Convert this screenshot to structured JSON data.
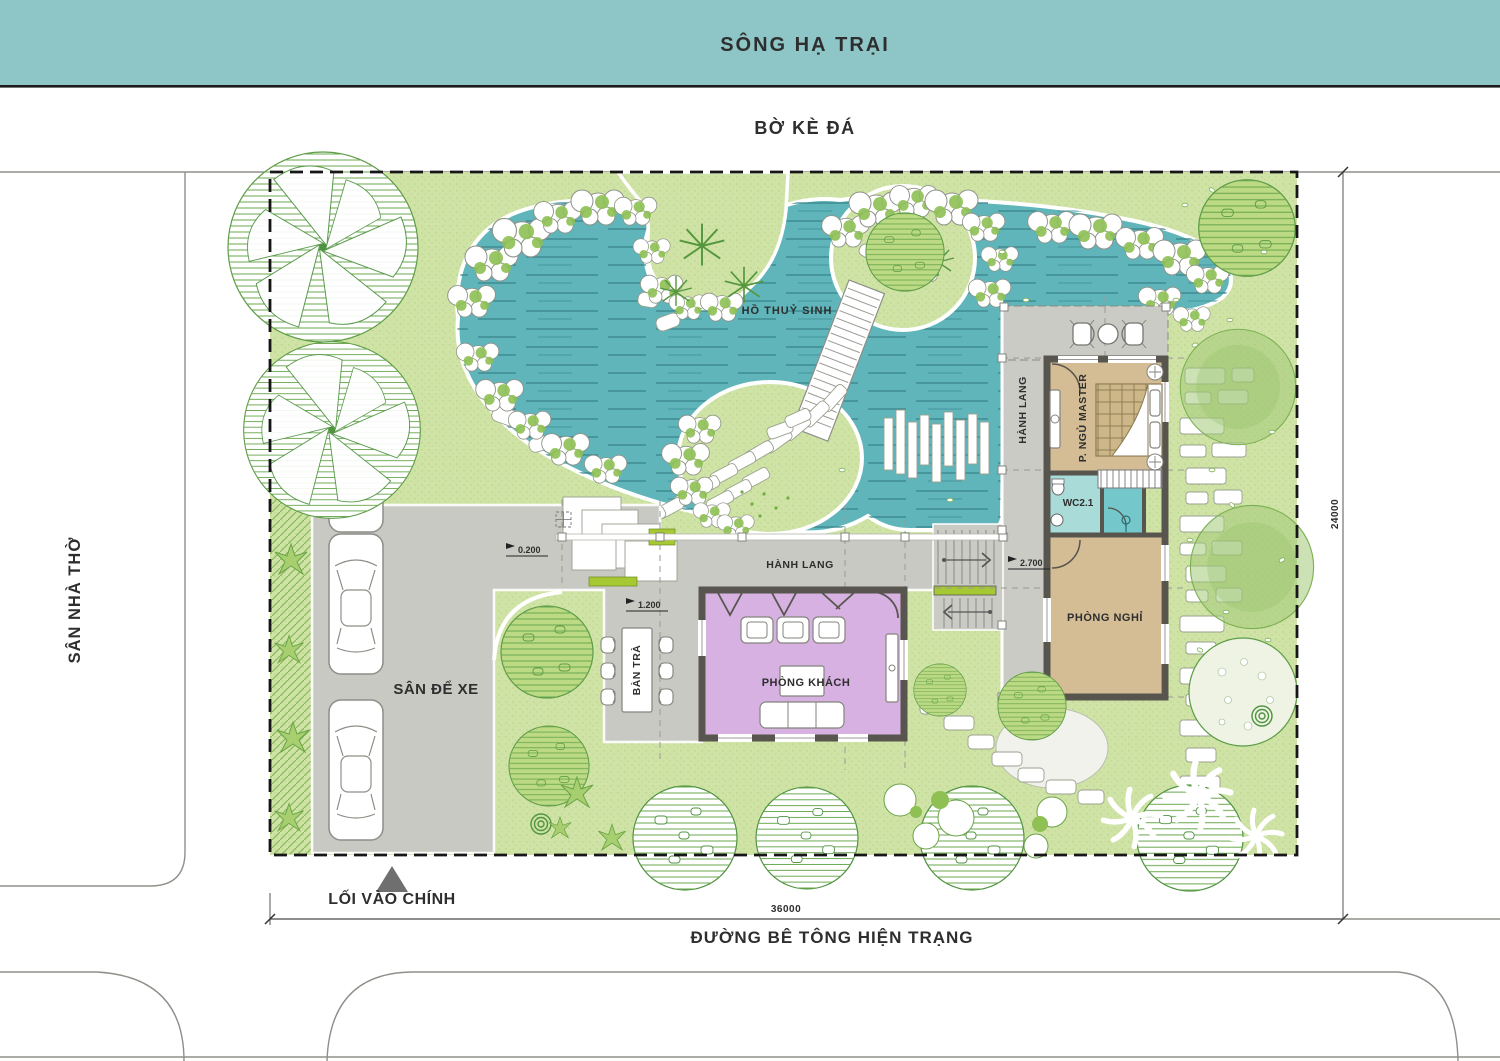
{
  "bands": {
    "river": "SÔNG HẠ TRẠI",
    "embankment": "BỜ KÈ ĐÁ"
  },
  "context": {
    "church_yard": "SÂN NHÀ THỜ",
    "road": "ĐƯỜNG BÊ TÔNG HIỆN TRẠNG",
    "main_entrance": "LỐI VÀO CHÍNH"
  },
  "site": {
    "pond": "HỒ THUỶ SINH",
    "parking": "SÂN ĐỂ XE"
  },
  "rooms": {
    "corridor_main": "HÀNH LANG",
    "corridor_side": "HÀNH LANG",
    "living_room": "PHÒNG KHÁCH",
    "tea_table": "BÀN TRÀ",
    "master_bedroom": "P. NGỦ MASTER",
    "wc": "WC2.1",
    "rest_room": "PHÒNG NGHỈ"
  },
  "levels": {
    "entry": "0.200",
    "living": "1.200",
    "upper": "2.700"
  },
  "dimensions": {
    "site_width": "36000",
    "site_depth": "24000"
  },
  "colors": {
    "water": "#5fb5ba",
    "river_band": "#8ec6c8",
    "lawn": "#cfe3a4",
    "paving": "#c9c9c4",
    "wall": "#57554e",
    "room_tan": "#d4bd95",
    "room_purple": "#d6b1e2",
    "room_wc": "#a9dbd8",
    "room_shower": "#74c8cc",
    "accent_green": "#a6c832"
  }
}
